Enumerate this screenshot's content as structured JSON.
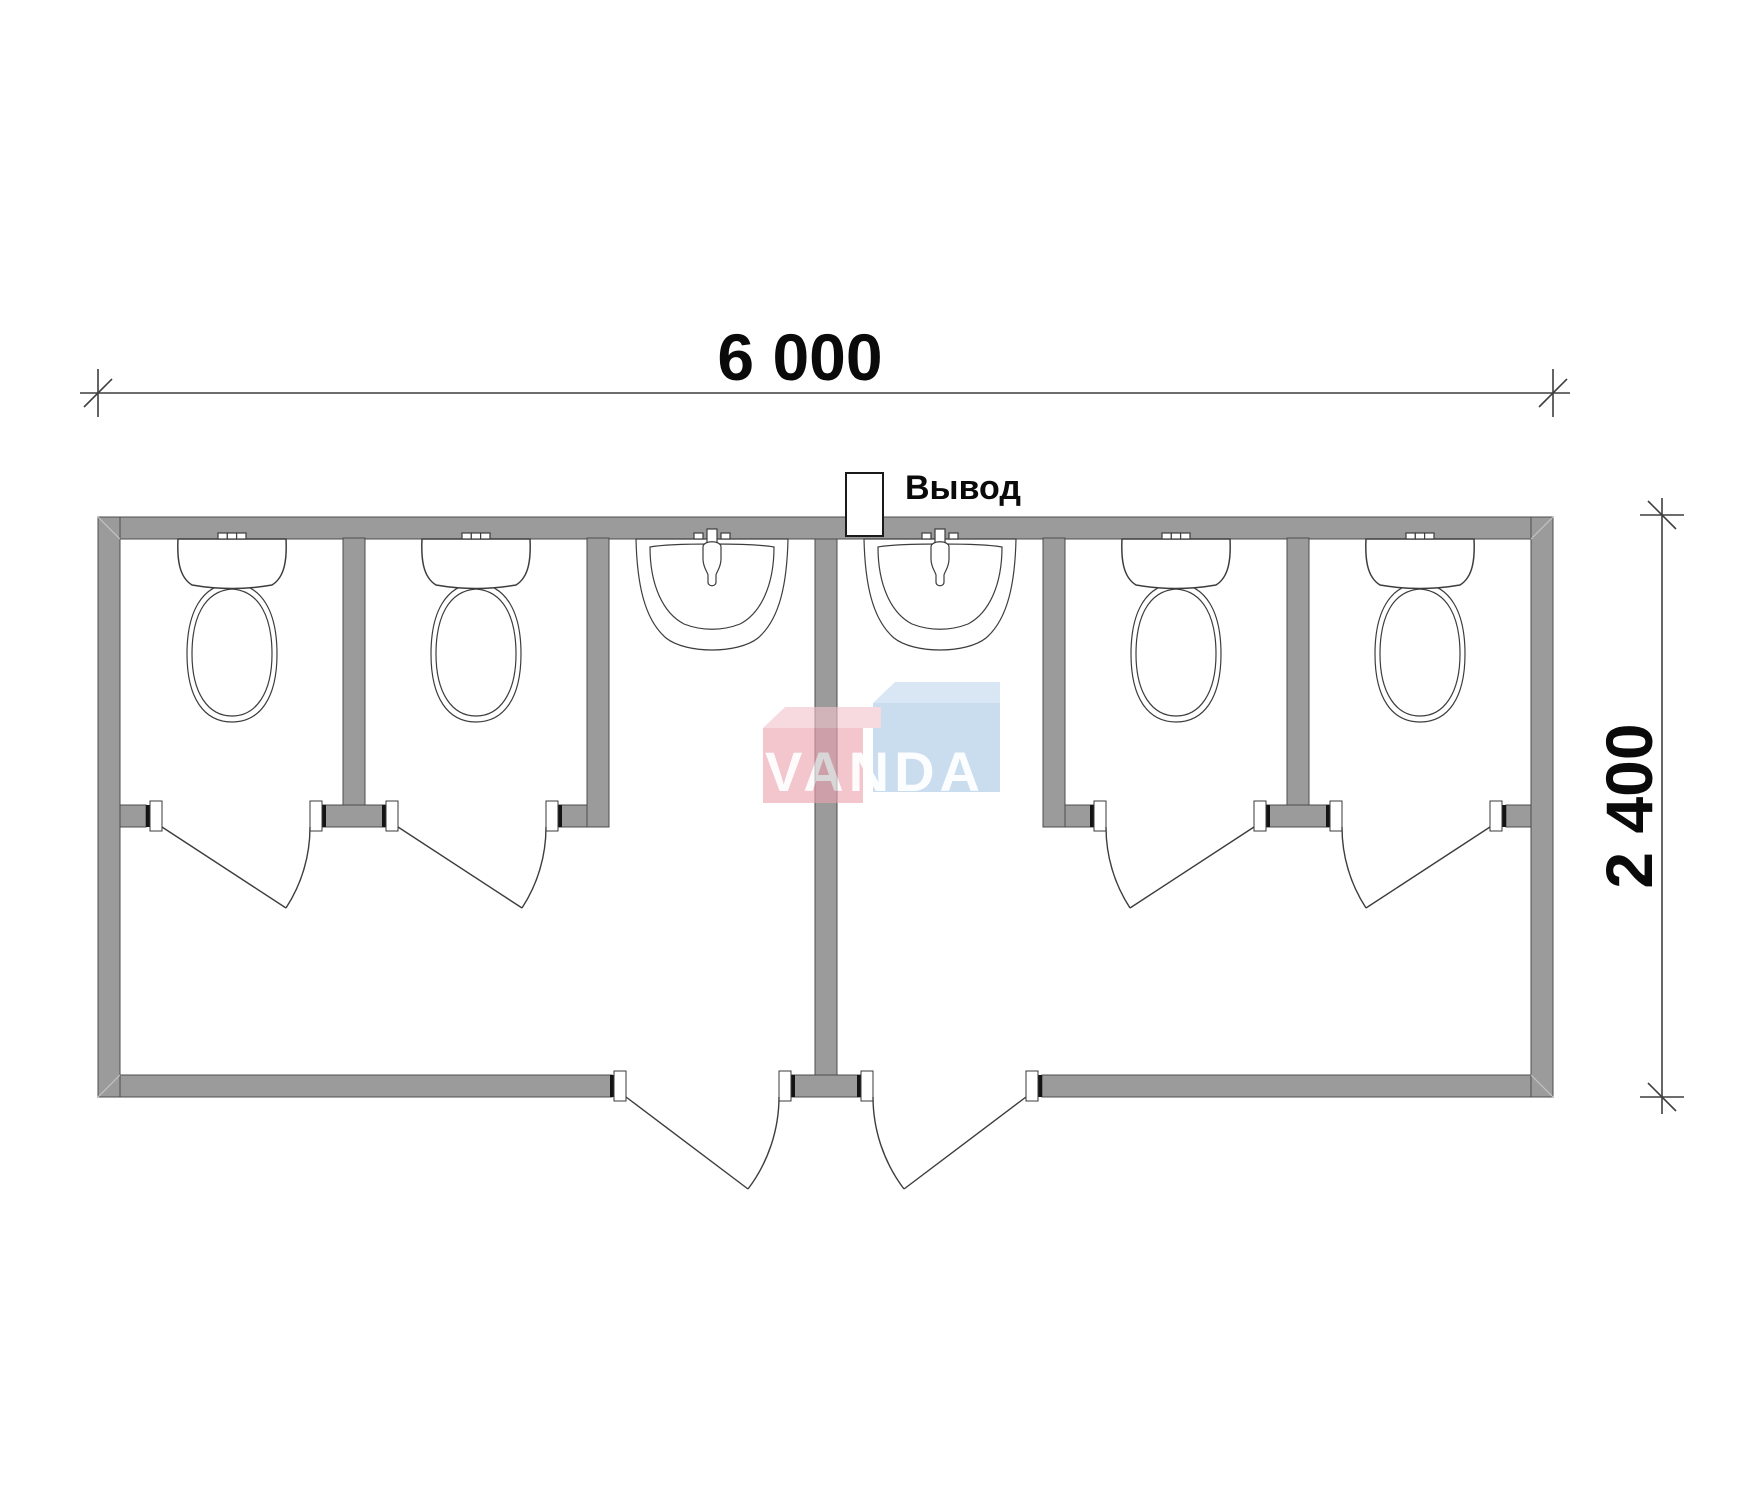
{
  "drawing": {
    "type": "floor-plan",
    "subject": "sanitary container block plan"
  },
  "dimensions": {
    "width_label": "6 000",
    "height_label": "2 400"
  },
  "outlet": {
    "label": "Вывод"
  },
  "watermark": {
    "brand": "VANDA",
    "pink_color": "#eda2b0",
    "blue_color": "#aac9e6"
  },
  "colors": {
    "wall_fill": "#9b9b9b",
    "wall_outline": "#4d4d4d",
    "line_work": "#3d3d3d",
    "background": "#ffffff"
  },
  "fixtures": {
    "toilets": 4,
    "washbasins": 2,
    "stall_doors": 4,
    "entrance_doors": 2
  }
}
